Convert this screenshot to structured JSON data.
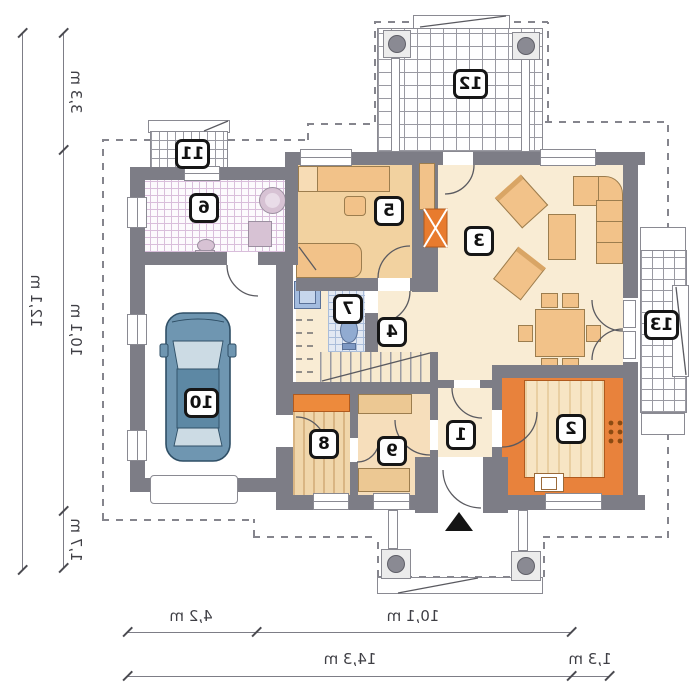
{
  "plan": {
    "rooms": {
      "r1": "1",
      "r2": "2",
      "r3": "3",
      "r4": "4",
      "r5": "5",
      "r6": "6",
      "r7": "7",
      "r8": "8",
      "r9": "9",
      "r10": "10",
      "r11": "11",
      "r12": "12",
      "r13": "13"
    },
    "dims": {
      "left_top": "3,3 m",
      "left_total": "12,1 m",
      "left_main": "10,1 m",
      "left_bottom": "1,7 m",
      "bottom_garage": "4,2 m",
      "bottom_main": "10,1 m",
      "bottom_total": "14,3 m",
      "bottom_side": "1,3 m"
    },
    "colors": {
      "wall": "#7d7d86",
      "floor_cream": "#f9ecd4",
      "floor_tan": "#f2d2a0",
      "kitchen_orange": "#e8823c",
      "furniture": "#f2c289",
      "car_blue": "#6f96b1",
      "fireplace_orange": "#e87b2e"
    }
  }
}
